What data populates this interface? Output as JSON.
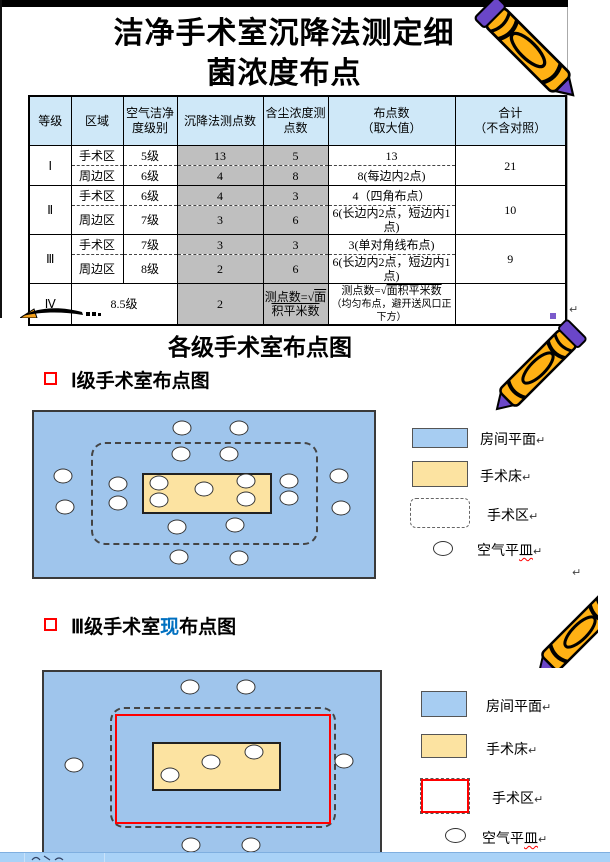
{
  "marks": {
    "pilcrow": "↵"
  },
  "slide1": {
    "title": "洁净手术室沉降法测定细\n菌浓度布点",
    "table": {
      "headers": [
        "等级",
        "区域",
        "空气洁净\n度级别",
        "沉降法测点数",
        "含尘浓度测\n点数",
        "布点数\n（取大值）",
        "合计\n（不含对照）"
      ],
      "rows": [
        {
          "grade": "Ⅰ",
          "total": "21",
          "zones": [
            {
              "zone": "手术区",
              "level": "5级",
              "settle": "13",
              "dust": "5",
              "points": "13"
            },
            {
              "zone": "周边区",
              "level": "6级",
              "settle": "4",
              "dust": "8",
              "points": "8(每边内2点)"
            }
          ]
        },
        {
          "grade": "Ⅱ",
          "total": "10",
          "zones": [
            {
              "zone": "手术区",
              "level": "6级",
              "settle": "4",
              "dust": "3",
              "points": "4（四角布点）"
            },
            {
              "zone": "周边区",
              "level": "7级",
              "settle": "3",
              "dust": "6",
              "points": "6(长边内2点，短边内1点)"
            }
          ]
        },
        {
          "grade": "Ⅲ",
          "total": "9",
          "zones": [
            {
              "zone": "手术区",
              "level": "7级",
              "settle": "3",
              "dust": "3",
              "points": "3(单对角线布点)"
            },
            {
              "zone": "周边区",
              "level": "8级",
              "settle": "2",
              "dust": "6",
              "points": "6(长边内2点，短边内1点)"
            }
          ]
        }
      ],
      "row4": {
        "grade": "Ⅳ",
        "level": "8.5级",
        "settle": "2",
        "formula_pre": "测点数=",
        "sqrt": "√",
        "formula_rad": "面积平米数",
        "note": "（均匀布点，避开送风口正下方）",
        "total": ""
      }
    }
  },
  "slide2": {
    "section_title": "各级手术室布点图",
    "bullet": "Ⅰ级手术室布点图",
    "diagram": {
      "points": [
        [
          43.5,
          9.7
        ],
        [
          60.3,
          9.7
        ],
        [
          43.2,
          25.5
        ],
        [
          57.4,
          25.5
        ],
        [
          8.5,
          38.8
        ],
        [
          9.1,
          57.6
        ],
        [
          24.7,
          43.6
        ],
        [
          24.7,
          55.2
        ],
        [
          36.8,
          43
        ],
        [
          36.8,
          53.3
        ],
        [
          50,
          46.7
        ],
        [
          62.4,
          41.8
        ],
        [
          62.4,
          52.7
        ],
        [
          75,
          41.8
        ],
        [
          75,
          52.1
        ],
        [
          89.7,
          38.8
        ],
        [
          90.3,
          58.2
        ],
        [
          42.1,
          69.7
        ],
        [
          59.1,
          68.5
        ],
        [
          42.6,
          87.9
        ],
        [
          60.3,
          88.5
        ]
      ]
    },
    "legend": {
      "items": [
        {
          "label": "房间平面"
        },
        {
          "label": "手术床"
        },
        {
          "label": "手术区"
        },
        {
          "label": "空气平",
          "label_misspelled": "皿"
        }
      ]
    }
  },
  "slide3": {
    "bullet_prefix": "Ⅲ级手术室",
    "bullet_highlight": "现",
    "bullet_suffix": "布点图",
    "diagram": {
      "points": [
        [
          43.5,
          8.2
        ],
        [
          60.1,
          8.2
        ],
        [
          8.9,
          51.1
        ],
        [
          89.3,
          48.9
        ],
        [
          37.5,
          56.6
        ],
        [
          49.7,
          49.5
        ],
        [
          62.5,
          44
        ],
        [
          43.8,
          95.1
        ],
        [
          61.6,
          95.1
        ]
      ]
    },
    "legend": {
      "items": [
        {
          "label": "房间平面"
        },
        {
          "label": "手术床"
        },
        {
          "label": "手术区"
        },
        {
          "label": "空气平",
          "label_misspelled": "皿"
        }
      ]
    }
  },
  "colors": {
    "room_fill": "#9fc5ec",
    "bed_fill": "#fce3a1",
    "zone_red": "#ff0000",
    "highlight_blue": "#0070c0",
    "header_bg": "#cfe8f8",
    "gray_cell": "#bfbfbf",
    "status_bar": "#a9d2f7"
  }
}
